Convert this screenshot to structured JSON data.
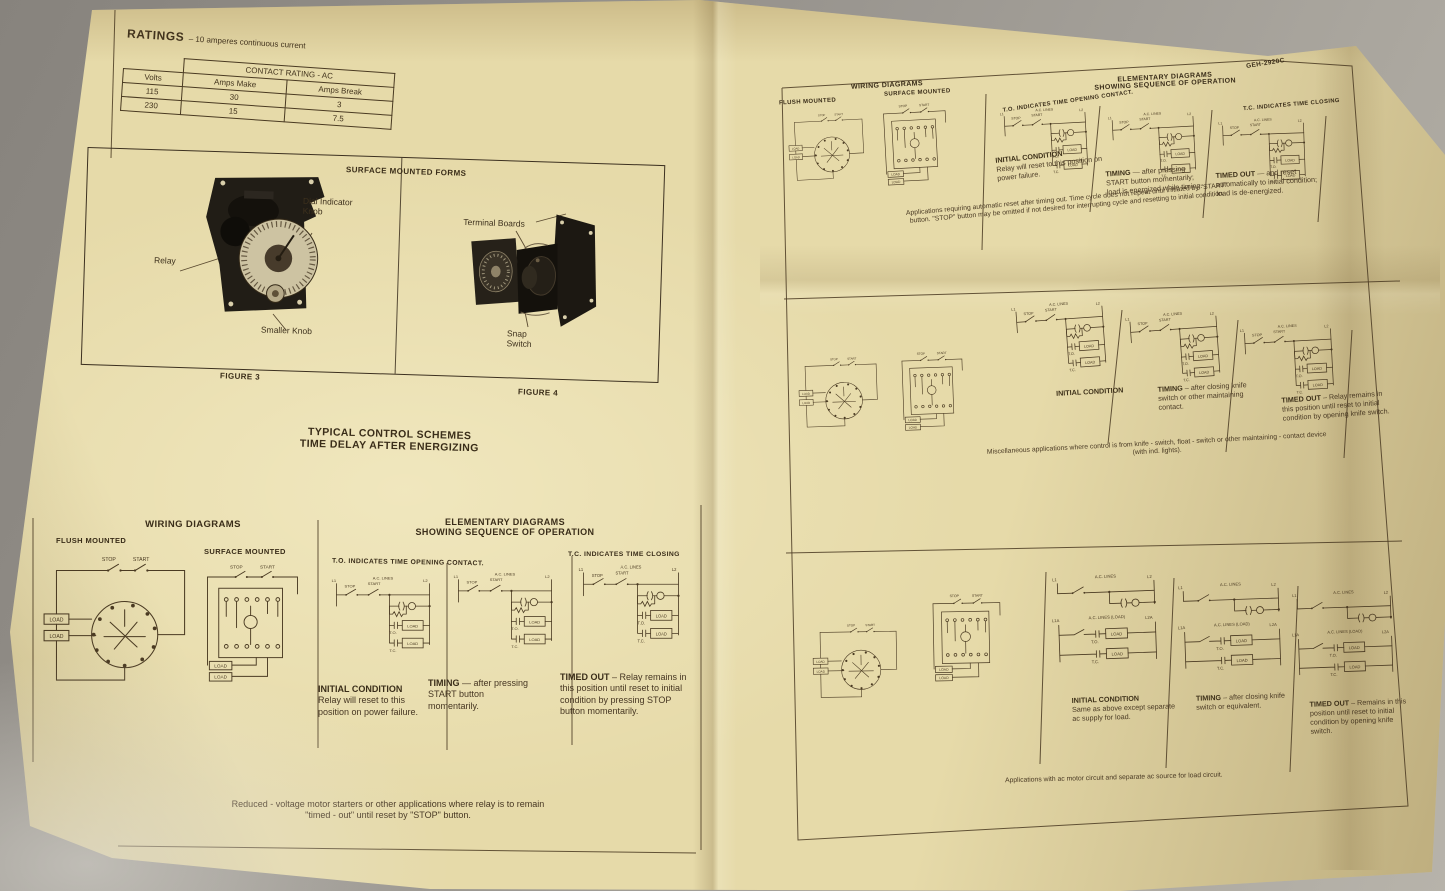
{
  "colors": {
    "background": "#96928b",
    "paper": "#e6daa9",
    "ink": "#3c3020"
  },
  "headings": {
    "wiring_diagrams": "WIRING DIAGRAMS",
    "flush_mounted": "FLUSH MOUNTED",
    "surface_mounted": "SURFACE MOUNTED",
    "elementary_line1": "ELEMENTARY DIAGRAMS",
    "elementary_line2": "SHOWING SEQUENCE OF OPERATION",
    "to_note": "T.O. INDICATES TIME OPENING CONTACT.",
    "tc_note": "T.C. INDICATES TIME CLOSING"
  },
  "d": {
    "l1": "L1",
    "l2": "L2",
    "l1a": "L1A",
    "l2a": "L2A",
    "ac": "A.C. LINES",
    "ac_load": "A.C. LINES (LOAD)",
    "stop": "STOP",
    "start": "START",
    "load": "LOAD",
    "to": "T.O.",
    "tc": "T.C."
  },
  "left_page": {
    "ratings": {
      "title_lead": "RATINGS",
      "title_rest": "– 10 amperes continuous current",
      "group_header": "CONTACT RATING - AC",
      "col_volts": "Volts",
      "col_make": "Amps Make",
      "col_break": "Amps Break",
      "rows": [
        [
          "115",
          "30",
          "3"
        ],
        [
          "230",
          "15",
          "7.5"
        ]
      ]
    },
    "figures_heading": "SURFACE MOUNTED FORMS",
    "figure3": {
      "caption": "FIGURE 3",
      "label_relay": "Relay",
      "label_dial": "Dial Indicator Knob",
      "label_smaller": "Smaller Knob"
    },
    "figure4": {
      "caption": "FIGURE 4",
      "label_terminal": "Terminal Boards",
      "label_snap": "Snap Switch"
    },
    "scheme_line1": "TYPICAL CONTROL SCHEMES",
    "scheme_line2": "TIME DELAY AFTER ENERGIZING",
    "initial": {
      "title": "INITIAL CONDITION",
      "body": "Relay will reset to this position on power failure."
    },
    "timing": {
      "title": "TIMING",
      "body": "— after pressing START button momentarily."
    },
    "timed": {
      "title": "TIMED OUT",
      "body": "– Relay remains in this position until reset to initial condition by pressing STOP button momentarily."
    },
    "caption": "Reduced - voltage motor starters or other applications where relay is to remain \"timed - out\" until reset by \"STOP\" button."
  },
  "right_page": {
    "doc_number": "GEH-2920C",
    "s1": {
      "initial": {
        "title": "INITIAL CONDITION",
        "body": "Relay will reset to this position on power failure."
      },
      "timing": {
        "title": "TIMING",
        "body": "— after pressing START button momentarily; load is energized while timing."
      },
      "timed": {
        "title": "TIMED OUT",
        "body": "— and reset automatically to initial condition; load is de-energized."
      },
      "caption": "Applications requiring automatic reset after timing out. Time cycle does not repeat until initiated by \"START\" button. \"STOP\" button may be omitted if not desired for interrupting cycle and resetting to initial condition."
    },
    "s2": {
      "initial": {
        "title": "INITIAL CONDITION",
        "body": ""
      },
      "timing": {
        "title": "TIMING",
        "body": "– after closing knife switch or other maintaining contact."
      },
      "timed": {
        "title": "TIMED OUT",
        "body": "– Relay remains in this position until reset to initial condition by opening knife switch."
      },
      "caption": "Miscellaneous applications where control is from knife - switch, float - switch or other maintaining - contact device (with ind. lights)."
    },
    "s3": {
      "initial": {
        "title": "INITIAL CONDITION",
        "body": "Same as above except separate ac supply for load."
      },
      "timing": {
        "title": "TIMING",
        "body": "– after closing knife switch or equivalent."
      },
      "timed": {
        "title": "TIMED OUT",
        "body": "– Remains in this position until reset to initial condition by opening knife switch."
      },
      "caption": "Applications with ac motor circuit and separate ac source for load circuit."
    }
  }
}
